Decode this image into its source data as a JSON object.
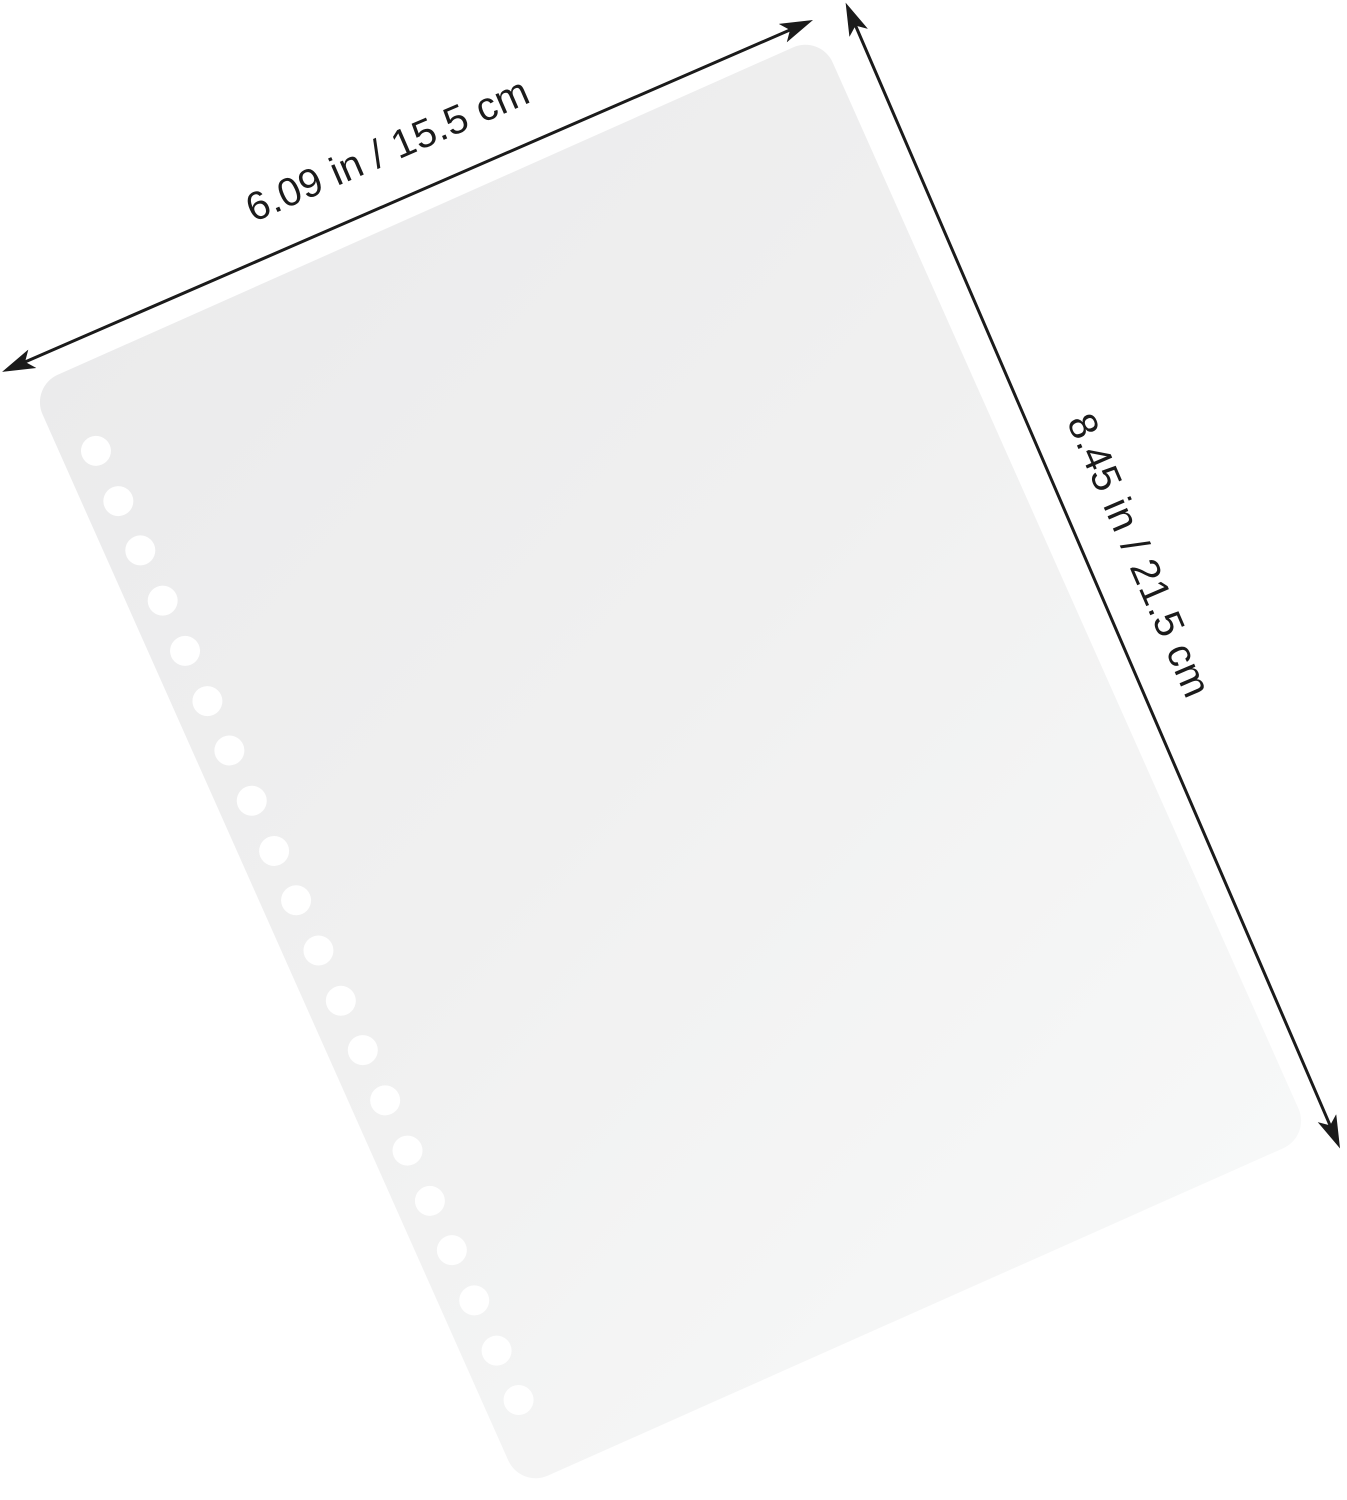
{
  "annotations": {
    "width_label": "6.09 in / 15.5 cm",
    "height_label": "8.45 in / 21.5 cm"
  },
  "sheet": {
    "hole_count": 20
  },
  "icons": {
    "arrow_left": "◄",
    "arrow_right": "►",
    "arrow_up": "▲",
    "arrow_down": "▼"
  },
  "colors": {
    "background": "#ffffff",
    "paper": "#f0f0f0",
    "paper_dark": "#ebebec",
    "paper_light": "#f7f8f8",
    "hole": "#ffffff",
    "line": "#1b1b1b",
    "text": "#1b1b1b"
  }
}
